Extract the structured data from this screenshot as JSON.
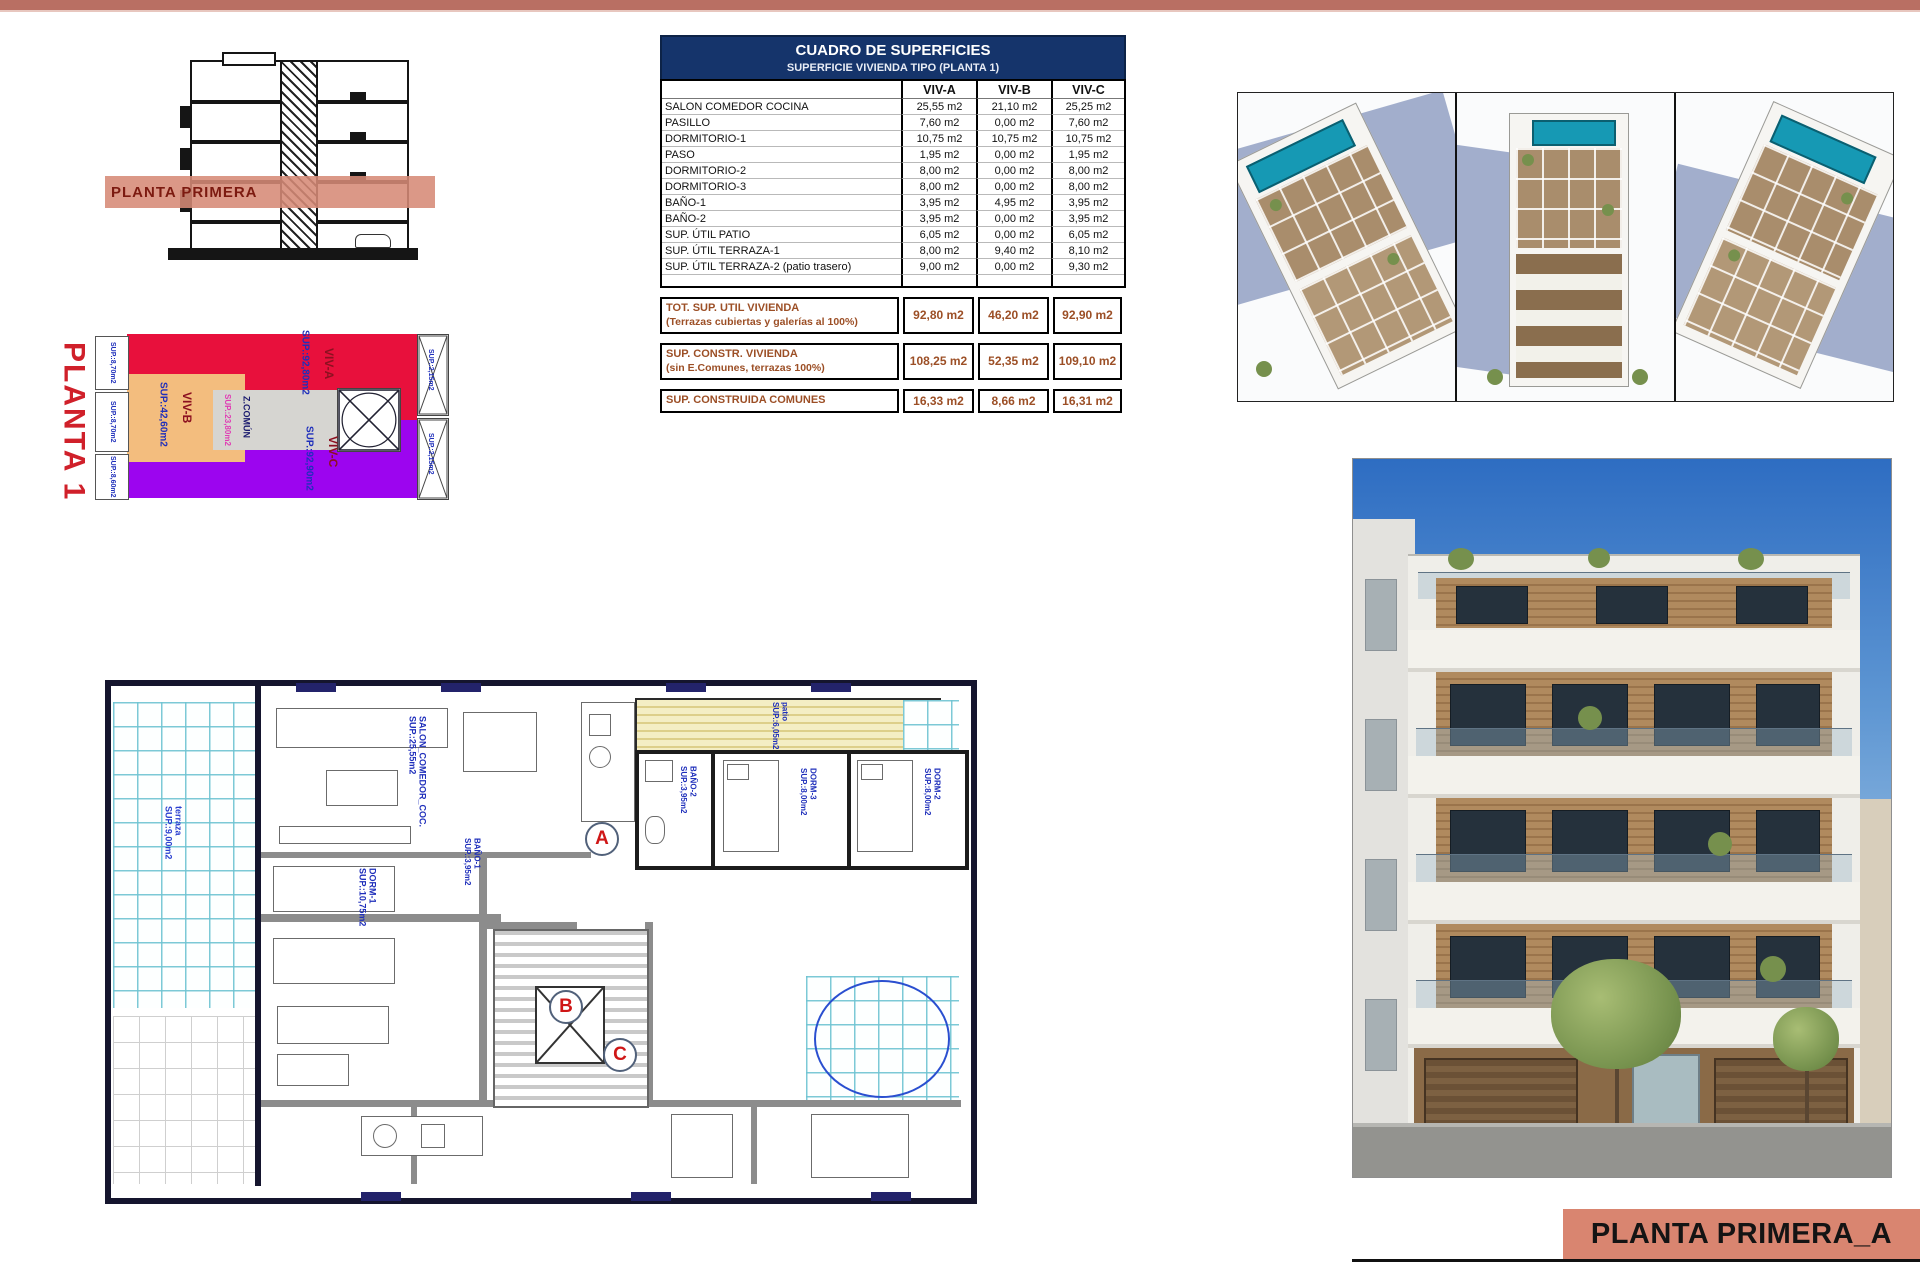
{
  "colors": {
    "top_bar": "#b96f63",
    "band_salmon": "#d68a76",
    "title_bar_salmon": "#d98570",
    "table_header_navy": "#15346b",
    "summary_brown": "#9c4f26",
    "viv_a_red": "#e8103c",
    "viv_b_orange": "#f3bd7e",
    "viv_c_purple": "#9c05ef",
    "common_gray": "#d6d5d1",
    "plan_label_blue": "#1f2fbb",
    "pool_teal": "#1699b4"
  },
  "section": {
    "band_label": "PLANTA PRIMERA"
  },
  "key_plan": {
    "title": "PLANTA 1",
    "areas": [
      {
        "label": "VIV-A",
        "sup": "SUP.:92,80m2"
      },
      {
        "label": "VIV-B",
        "sup": "SUP.:42,60m2"
      },
      {
        "label": "VIV-C",
        "sup": "SUP.:92,90m2"
      },
      {
        "label": "Z.COMÚN",
        "sup": "SUP.:23,80m2"
      }
    ],
    "left_tabs": [
      "SUP.:8,70m2",
      "SUP.:8,70m2",
      "SUP.:8,60m2"
    ],
    "right_tabs": [
      "SUP.:2,15m2",
      "SUP.:2,15m2"
    ]
  },
  "surface_table": {
    "title": "CUADRO DE SUPERFICIES",
    "subtitle": "SUPERFICIE VIVIENDA TIPO  (PLANTA 1)",
    "columns": [
      "VIV-A",
      "VIV-B",
      "VIV-C"
    ],
    "rows": [
      {
        "label": "SALON COMEDOR COCINA",
        "values": [
          "25,55 m2",
          "21,10 m2",
          "25,25 m2"
        ]
      },
      {
        "label": "PASILLO",
        "values": [
          "7,60 m2",
          "0,00 m2",
          "7,60 m2"
        ]
      },
      {
        "label": "DORMITORIO-1",
        "values": [
          "10,75 m2",
          "10,75 m2",
          "10,75 m2"
        ]
      },
      {
        "label": "PASO",
        "values": [
          "1,95 m2",
          "0,00 m2",
          "1,95 m2"
        ]
      },
      {
        "label": "DORMITORIO-2",
        "values": [
          "8,00 m2",
          "0,00 m2",
          "8,00 m2"
        ]
      },
      {
        "label": "DORMITORIO-3",
        "values": [
          "8,00 m2",
          "0,00 m2",
          "8,00 m2"
        ]
      },
      {
        "label": "BAÑO-1",
        "values": [
          "3,95 m2",
          "4,95 m2",
          "3,95 m2"
        ]
      },
      {
        "label": "BAÑO-2",
        "values": [
          "3,95 m2",
          "0,00 m2",
          "3,95 m2"
        ]
      },
      {
        "label": "SUP. ÚTIL PATIO",
        "values": [
          "6,05 m2",
          "0,00 m2",
          "6,05 m2"
        ]
      },
      {
        "label": "SUP. ÚTIL TERRAZA-1",
        "values": [
          "8,00 m2",
          "9,40 m2",
          "8,10 m2"
        ]
      },
      {
        "label": "SUP. ÚTIL TERRAZA-2 (patio trasero)",
        "values": [
          "9,00 m2",
          "0,00 m2",
          "9,30 m2"
        ]
      }
    ],
    "summary_rows": [
      {
        "label": "TOT. SUP. UTIL VIVIENDA",
        "sublabel": "(Terrazas cubiertas y galerías al 100%)",
        "values": [
          "92,80 m2",
          "46,20 m2",
          "92,90 m2"
        ]
      },
      {
        "label": "SUP. CONSTR. VIVIENDA",
        "sublabel": "(sin E.Comunes, terrazas 100%)",
        "values": [
          "108,25 m2",
          "52,35 m2",
          "109,10 m2"
        ]
      },
      {
        "label": "SUP. CONSTRUIDA COMUNES",
        "sublabel": "",
        "values": [
          "16,33 m2",
          "8,66 m2",
          "16,31 m2"
        ]
      }
    ]
  },
  "floor_plan": {
    "markers": [
      "A",
      "B",
      "C"
    ],
    "labels": [
      {
        "text": "SALON_COMEDOR_COC.",
        "sup": "SUP.:25,55m2"
      },
      {
        "text": "DORM-1",
        "sup": "SUP.:10,75m2"
      },
      {
        "text": "BAÑO-1",
        "sup": "SUP.:3,95m2"
      },
      {
        "text": "BAÑO-2",
        "sup": "SUP.:3,95m2"
      },
      {
        "text": "DORM-3",
        "sup": "SUP.:8,00m2"
      },
      {
        "text": "DORM-2",
        "sup": "SUP.:8,00m2"
      },
      {
        "text": "patio",
        "sup": "SUP.:6,05m2"
      },
      {
        "text": "terraza",
        "sup": "SUP.:9,00m2"
      }
    ]
  },
  "title_block": {
    "label": "PLANTA PRIMERA_A"
  }
}
